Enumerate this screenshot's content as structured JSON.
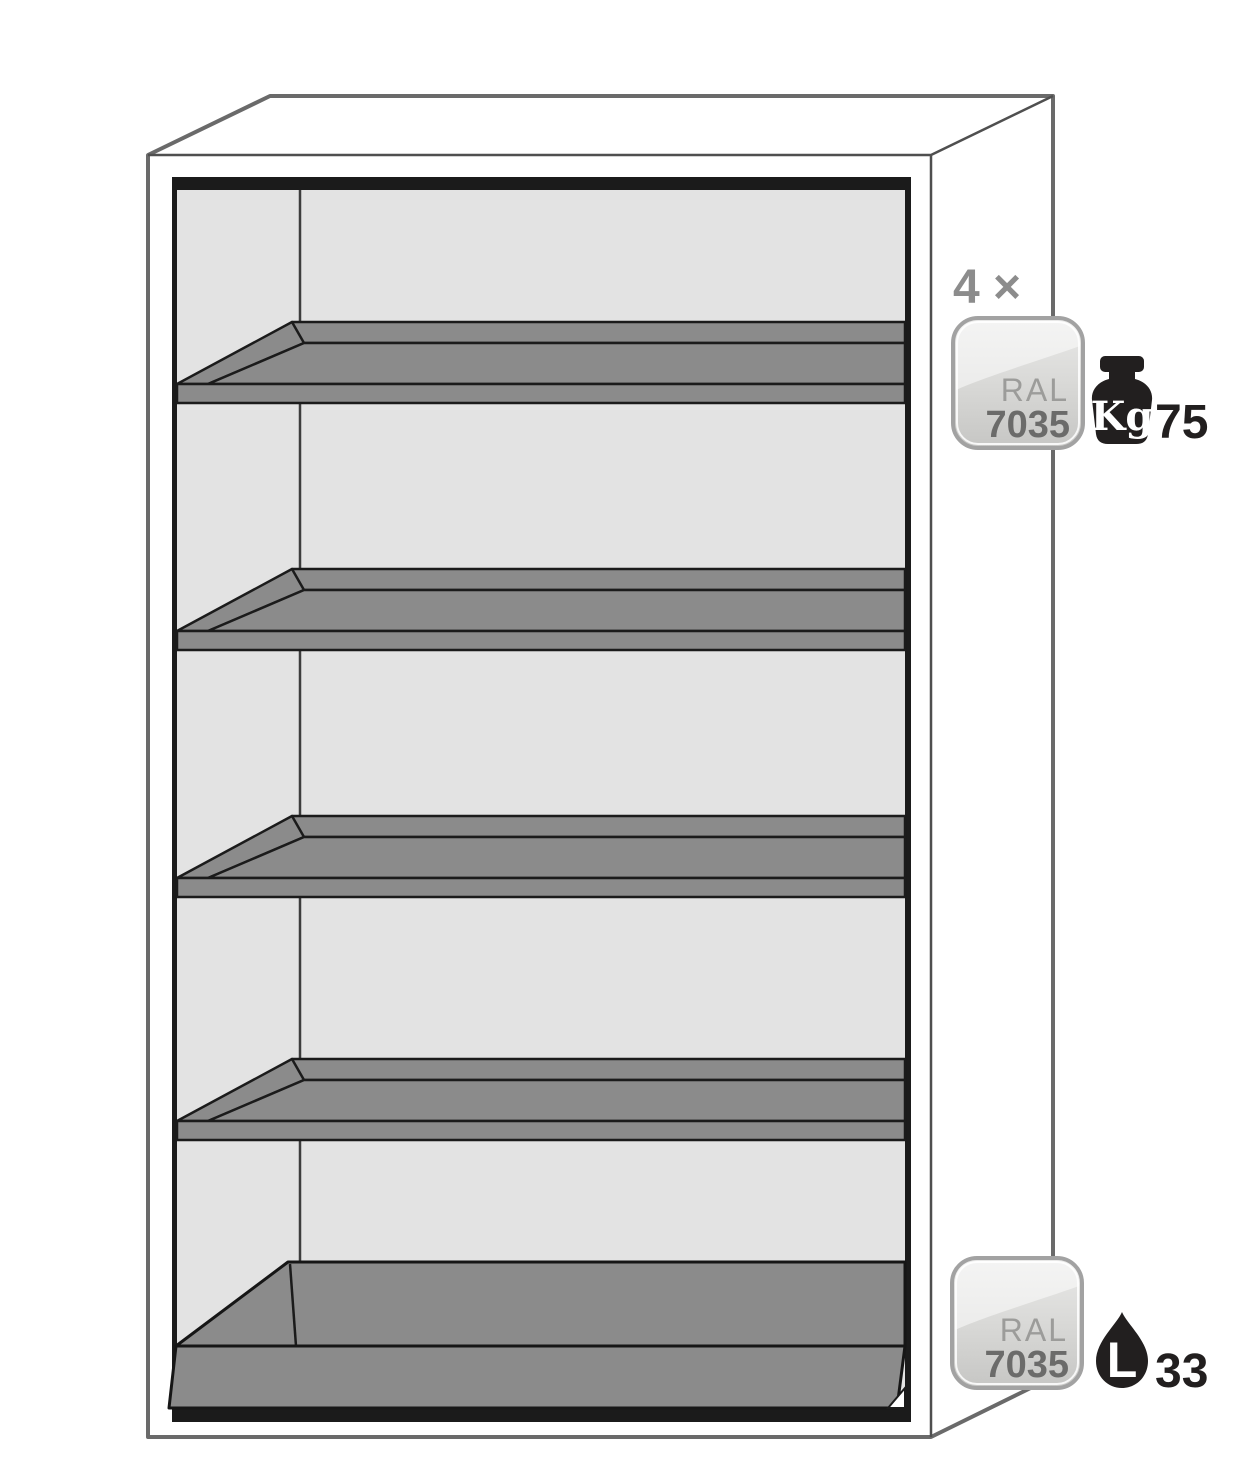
{
  "figure": {
    "shelf_count": 4,
    "has_bottom_sump": true
  },
  "callouts": {
    "shelves": {
      "count_label": "4 ×",
      "badge": {
        "standard": "RAL",
        "code": "7035"
      },
      "load": {
        "unit": "Kg",
        "value": "75"
      }
    },
    "sump": {
      "badge": {
        "standard": "RAL",
        "code": "7035"
      },
      "capacity": {
        "unit": "L",
        "value": "33"
      }
    }
  },
  "colors": {
    "shelf_gray": "#8b8b8b",
    "interior_gray": "#e3e3e3",
    "outline_gray": "#6a6a6a",
    "line_black": "#1b1b1b",
    "badge_border": "#a2a2a2",
    "badge_label": "#9c9c9a",
    "badge_code": "#6b6b6a",
    "count_label": "#8c8c8c",
    "icon_black": "#221f1f"
  }
}
